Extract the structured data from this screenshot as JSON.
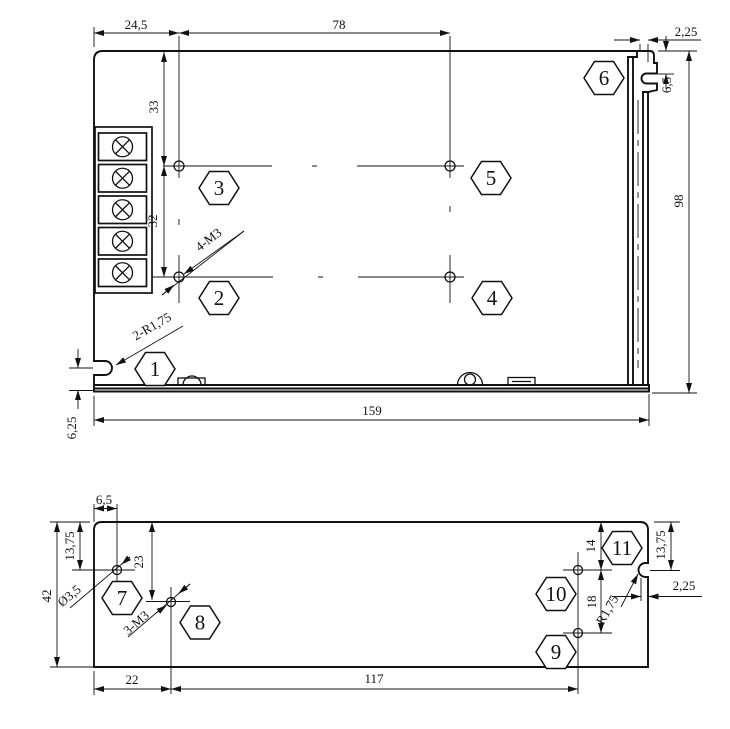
{
  "drawing": {
    "colors": {
      "line": "#111111",
      "background": "#ffffff"
    },
    "top": {
      "dims": {
        "w1": "24,5",
        "w2": "78",
        "tab_w": "2,25",
        "tab_d": "6,5",
        "h1": "33",
        "h2": "32",
        "height": "98",
        "width": "159",
        "slot": "6,25"
      },
      "labels": {
        "holes": "4-M3",
        "corners": "2-R1,75"
      },
      "callouts": [
        "1",
        "2",
        "3",
        "4",
        "5",
        "6"
      ]
    },
    "bottom": {
      "dims": {
        "hx": "6,5",
        "hy": "13,75",
        "h8y": "23",
        "height": "42",
        "w1": "22",
        "w2": "117",
        "d14": "14",
        "d18": "18",
        "notch_y": "13,75",
        "notch_d": "2,25"
      },
      "labels": {
        "dia": "Ø3,5",
        "holes": "3-M3",
        "radius": "R1,75"
      },
      "callouts": [
        "7",
        "8",
        "9",
        "10",
        "11"
      ]
    }
  }
}
